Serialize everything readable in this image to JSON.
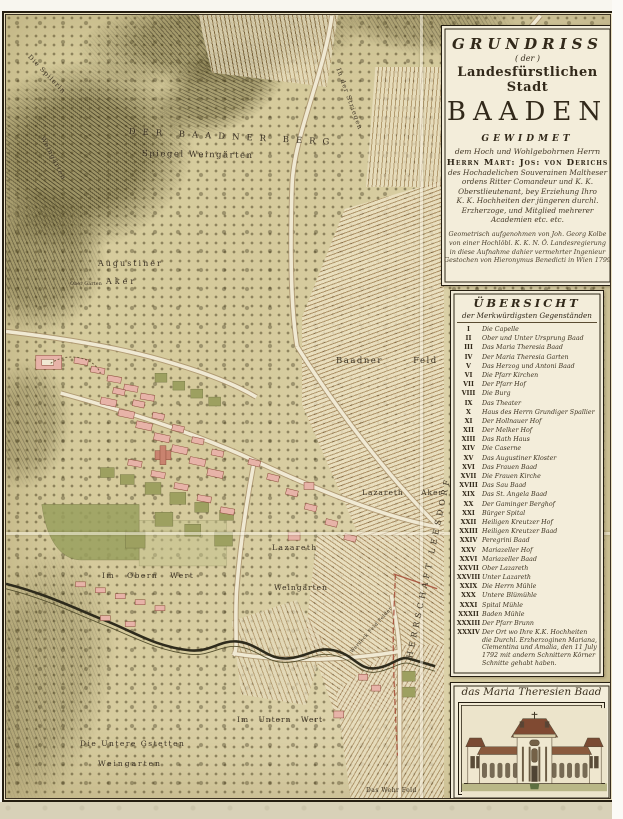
{
  "cartouche": {
    "title1": "GRUNDRISS",
    "title2": "( der )",
    "title3": "Landesfürstlichen Stadt",
    "title4": "BAADEN",
    "dedication_heading": "GEWIDMET",
    "dedication_intro": "dem Hoch und Wohlgebohrnen Herrn",
    "dedication_name": "Herrn Mart: Jos: von Derichs",
    "dedication_lines": [
      "des Hochadelichen Souverainen Maltheser",
      "ordens Ritter Comandeur und K. K.",
      "Oberstlieutenant, bey Erziehung Ihro",
      "K. K. Hochheiten der jüngeren durchl.",
      "Erzherzoge, und Mitglied mehrerer",
      "Academien etc. etc."
    ],
    "attribution_lines": [
      "Geometrisch aufgenohmen von Joh. Georg Kolbe",
      "von einer Hochlöbl. K. K. N. Ö. Landesregierung",
      "in diese Aufnahme dahier vermehrter Ingenieur",
      "Gestochen von Hieronymus Benedicti in Wien 1799"
    ]
  },
  "legend": {
    "heading": "ÜBERSICHT",
    "subheading": "der Merkwürdigsten Gegenständen",
    "items": [
      {
        "num": "I",
        "name": "Die Capelle"
      },
      {
        "num": "II",
        "name": "Ober und Unter Ursprung Baad"
      },
      {
        "num": "III",
        "name": "Das Maria Theresia Baad"
      },
      {
        "num": "IV",
        "name": "Der Maria Theresia Garten"
      },
      {
        "num": "V",
        "name": "Das Herzog und Antoni Baad"
      },
      {
        "num": "VI",
        "name": "Die Pfarr Kirchen"
      },
      {
        "num": "VII",
        "name": "Der Pfarr Hof"
      },
      {
        "num": "VIII",
        "name": "Die Burg"
      },
      {
        "num": "IX",
        "name": "Das Theater"
      },
      {
        "num": "X",
        "name": "Haus des Herrn Grundiger Spallier"
      },
      {
        "num": "XI",
        "name": "Der Hollnauer Hof"
      },
      {
        "num": "XII",
        "name": "Der Melker Hof"
      },
      {
        "num": "XIII",
        "name": "Das Rath Haus"
      },
      {
        "num": "XIV",
        "name": "Die Caserne"
      },
      {
        "num": "XV",
        "name": "Das Augustiner Kloster"
      },
      {
        "num": "XVI",
        "name": "Das Frauen Baad"
      },
      {
        "num": "XVII",
        "name": "Die Frauen Kirche"
      },
      {
        "num": "XVIII",
        "name": "Das Sau Baad"
      },
      {
        "num": "XIX",
        "name": "Das St. Angela Baad"
      },
      {
        "num": "XX",
        "name": "Der Gaminger Berghof"
      },
      {
        "num": "XXI",
        "name": "Bürger Spital"
      },
      {
        "num": "XXII",
        "name": "Heiligen Kreutzer Hof"
      },
      {
        "num": "XXIII",
        "name": "Heiligen Kreutzer Baad"
      },
      {
        "num": "XXIV",
        "name": "Peregrini Baad"
      },
      {
        "num": "XXV",
        "name": "Mariazeller Hof"
      },
      {
        "num": "XXVI",
        "name": "Mariazeller Baad"
      },
      {
        "num": "XXVII",
        "name": "Ober Lazareth"
      },
      {
        "num": "XXVIII",
        "name": "Unter Lazareth"
      },
      {
        "num": "XXIX",
        "name": "Die Herrn Mühle"
      },
      {
        "num": "XXX",
        "name": "Untere Blümühle"
      },
      {
        "num": "XXXI",
        "name": "Spital Mühle"
      },
      {
        "num": "XXXII",
        "name": "Baden Mühle"
      },
      {
        "num": "XXXIII",
        "name": "Der Pfarr Brunn"
      },
      {
        "num": "XXXIV",
        "name": "Der Ort wo Ihre K.K. Hochheiten die Durchl. Erzherzoginen Mariana, Clementina und Amalia, den 11 July 1792 mit andern Schnittern Körner Schnitte gehabt haben."
      }
    ]
  },
  "vignette": {
    "caption": "das Maria Theresien Baad"
  },
  "map_labels": [
    {
      "text": "DER BAADNER BERG",
      "x": 123,
      "y": 112,
      "rot": 3,
      "fs": 8.5,
      "ls": 7
    },
    {
      "text": "Spiegel Weingärten",
      "x": 136,
      "y": 134,
      "rot": 1,
      "fs": 8.5,
      "ls": 1.5
    },
    {
      "text": "Die Spilerin",
      "x": 26,
      "y": 38,
      "rot": 46,
      "fs": 6.5,
      "ls": 1
    },
    {
      "text": "Weingärten",
      "x": 40,
      "y": 120,
      "rot": 63,
      "fs": 6.5,
      "ls": 1
    },
    {
      "text": "In der Striegen",
      "x": 336,
      "y": 52,
      "rot": 70,
      "fs": 6.5,
      "ls": 1
    },
    {
      "text": "Augustiner",
      "x": 92,
      "y": 244,
      "rot": 0,
      "fs": 8,
      "ls": 2
    },
    {
      "text": "Aker",
      "x": 100,
      "y": 262,
      "rot": 0,
      "fs": 8,
      "ls": 3
    },
    {
      "text": "Ober Gärten",
      "x": 64,
      "y": 266,
      "rot": 0,
      "fs": 5,
      "ls": 0
    },
    {
      "text": "Baadner Feld",
      "x": 330,
      "y": 341,
      "rot": 0,
      "fs": 8.5,
      "ls": 1.5,
      "ws": 26
    },
    {
      "text": "Lazareth Aker",
      "x": 356,
      "y": 473,
      "rot": 0,
      "fs": 7.5,
      "ls": 1,
      "ws": 14
    },
    {
      "text": "Lazareth",
      "x": 266,
      "y": 528,
      "rot": 0,
      "fs": 7.5,
      "ls": 1.5
    },
    {
      "text": "Im Obern Wert",
      "x": 96,
      "y": 556,
      "rot": 0,
      "fs": 7.5,
      "ls": 1.5,
      "ws": 8
    },
    {
      "text": "Weingärten",
      "x": 268,
      "y": 568,
      "rot": 0,
      "fs": 7.5,
      "ls": 1
    },
    {
      "text": "HERRSCHAFT LEESDORF",
      "x": 399,
      "y": 642,
      "rot": -78,
      "fs": 8,
      "ls": 4
    },
    {
      "text": "Werdeck Feld Felder",
      "x": 344,
      "y": 636,
      "rot": -48,
      "fs": 4.8,
      "ls": 0.5
    },
    {
      "text": "Im Untern Wert",
      "x": 231,
      "y": 700,
      "rot": 0,
      "fs": 7.5,
      "ls": 1,
      "ws": 6
    },
    {
      "text": "Die Untere Gstetten",
      "x": 74,
      "y": 724,
      "rot": 0,
      "fs": 7.5,
      "ls": 1.5
    },
    {
      "text": "Weingarten",
      "x": 92,
      "y": 744,
      "rot": 0,
      "fs": 7.5,
      "ls": 2
    },
    {
      "text": "Das Wehr Feld",
      "x": 360,
      "y": 772,
      "rot": 0,
      "fs": 6,
      "ls": 0.5
    }
  ],
  "colors": {
    "paper": "#d7cd9f",
    "panel": "#f3edda",
    "frame": "#241d10",
    "building_pink": "#e7b3a8",
    "church_red": "#c9836f",
    "garden_green": "#9aa05e",
    "boundary_red": "#a8503a",
    "stripe_brown": "#8a6238"
  }
}
